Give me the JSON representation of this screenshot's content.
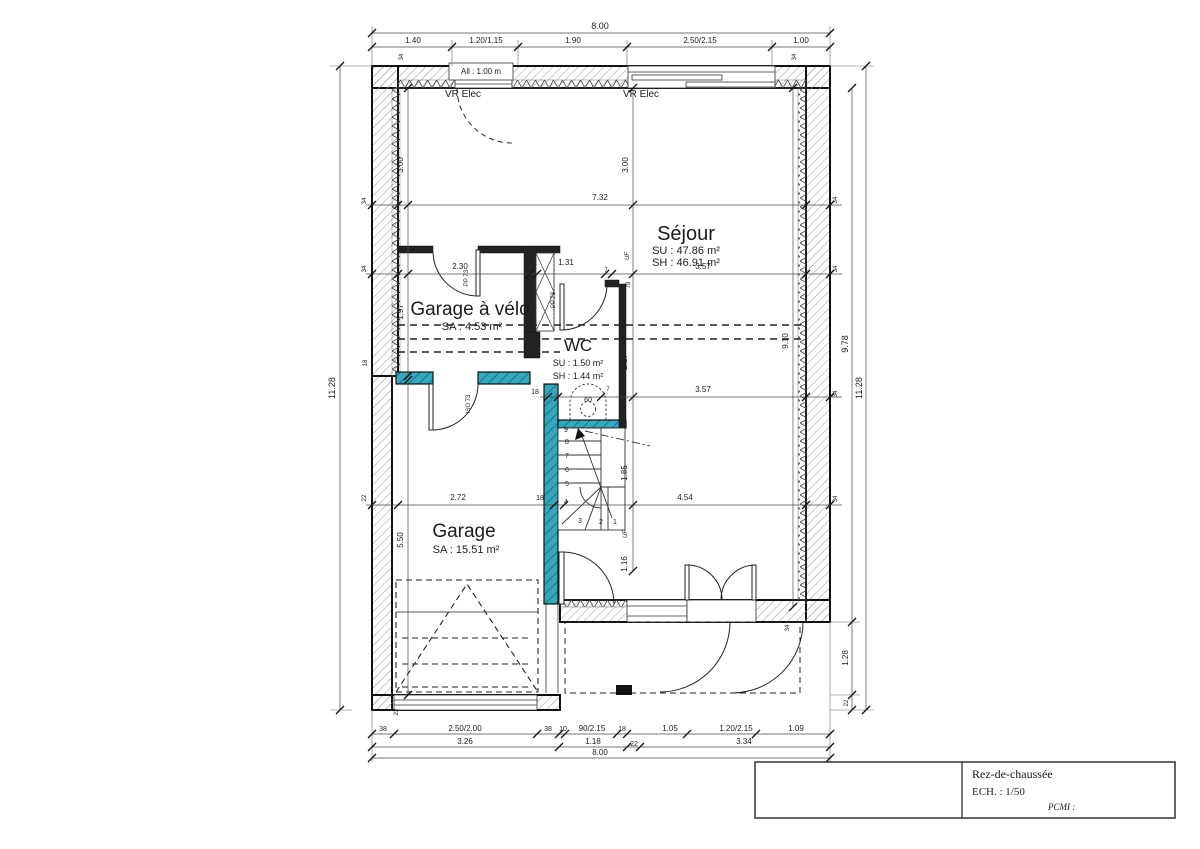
{
  "title_block": {
    "floor_label": "Rez-de-chaussée",
    "scale_label": "ECH. : 1/50",
    "pcmi_label": "PCMI :"
  },
  "rooms": {
    "sejour": {
      "name": "Séjour",
      "line1": "SU : 47.86 m²",
      "line2": "SH : 46.91 m²"
    },
    "garage_velo": {
      "name": "Garage à vélo",
      "line1": "SA : 4.53 m²"
    },
    "wc": {
      "name": "WC",
      "line1": "SU : 1.50 m²",
      "line2": "SH : 1.44 m²"
    },
    "garage": {
      "name": "Garage",
      "line1": "SA : 15.51 m²"
    }
  },
  "colors": {
    "wall_line": "#111111",
    "teal_wall": "#35a8bc",
    "hatch": "#8a8a8a"
  },
  "annotations": [
    {
      "t": "8.00",
      "x": 600,
      "y": 29,
      "s": 9
    },
    {
      "t": "1.40",
      "x": 413,
      "y": 43,
      "s": 8
    },
    {
      "t": "1.20/1.15",
      "x": 486,
      "y": 43,
      "s": 8
    },
    {
      "t": "1.90",
      "x": 573,
      "y": 43,
      "s": 8
    },
    {
      "t": "2.50/2.15",
      "x": 700,
      "y": 43,
      "s": 8
    },
    {
      "t": "1.00",
      "x": 801,
      "y": 43,
      "s": 8
    },
    {
      "t": "All : 1.00 m",
      "x": 481,
      "y": 74,
      "s": 8
    },
    {
      "t": "VR Elec",
      "x": 463,
      "y": 97,
      "s": 10
    },
    {
      "t": "VR Elec",
      "x": 641,
      "y": 97,
      "s": 10
    },
    {
      "t": "34",
      "x": 403,
      "y": 57,
      "r": -90,
      "s": 6
    },
    {
      "t": "34",
      "x": 796,
      "y": 57,
      "r": -90,
      "s": 6
    },
    {
      "t": "11.28",
      "x": 335,
      "y": 388,
      "r": -90,
      "s": 9
    },
    {
      "t": "34",
      "x": 366,
      "y": 201,
      "r": -90,
      "s": 6
    },
    {
      "t": "34",
      "x": 366,
      "y": 269,
      "r": -90,
      "s": 6
    },
    {
      "t": "18",
      "x": 367,
      "y": 363,
      "r": -90,
      "s": 6
    },
    {
      "t": "22",
      "x": 366,
      "y": 498,
      "r": -90,
      "s": 6
    },
    {
      "t": "3.00",
      "x": 403,
      "y": 165,
      "r": -90,
      "s": 8
    },
    {
      "t": "1.97",
      "x": 403,
      "y": 312,
      "r": -90,
      "s": 8
    },
    {
      "t": "5.50",
      "x": 403,
      "y": 540,
      "r": -90,
      "s": 8
    },
    {
      "t": "22",
      "x": 398,
      "y": 712,
      "r": -90,
      "s": 6
    },
    {
      "t": "9.78",
      "x": 848,
      "y": 344,
      "r": -90,
      "s": 9
    },
    {
      "t": "11.28",
      "x": 862,
      "y": 388,
      "r": -90,
      "s": 9
    },
    {
      "t": "1.28",
      "x": 848,
      "y": 658,
      "r": -90,
      "s": 8
    },
    {
      "t": "22",
      "x": 848,
      "y": 703,
      "r": -90,
      "s": 6
    },
    {
      "t": "34",
      "x": 837,
      "y": 200,
      "r": -90,
      "s": 6
    },
    {
      "t": "34",
      "x": 837,
      "y": 269,
      "r": -90,
      "s": 6
    },
    {
      "t": "34",
      "x": 837,
      "y": 394,
      "r": -90,
      "s": 6
    },
    {
      "t": "34",
      "x": 837,
      "y": 499,
      "r": -90,
      "s": 6
    },
    {
      "t": "34",
      "x": 789,
      "y": 628,
      "r": -90,
      "s": 6
    },
    {
      "t": "3.00",
      "x": 628,
      "y": 165,
      "r": -90,
      "s": 8
    },
    {
      "t": "7.32",
      "x": 600,
      "y": 200,
      "s": 8
    },
    {
      "t": "2.30",
      "x": 460,
      "y": 269,
      "s": 8
    },
    {
      "t": "1.31",
      "x": 566,
      "y": 265,
      "s": 8
    },
    {
      "t": "3.57",
      "x": 703,
      "y": 269,
      "s": 8
    },
    {
      "t": "3.57",
      "x": 703,
      "y": 392,
      "s": 8
    },
    {
      "t": "2.17",
      "x": 627,
      "y": 362,
      "r": -90,
      "s": 8
    },
    {
      "t": "9.10",
      "x": 788,
      "y": 341,
      "r": -90,
      "s": 8
    },
    {
      "t": "1.85",
      "x": 627,
      "y": 473,
      "r": -90,
      "s": 8
    },
    {
      "t": "1.16",
      "x": 627,
      "y": 564,
      "r": -90,
      "s": 8
    },
    {
      "t": "2.72",
      "x": 458,
      "y": 500,
      "s": 8
    },
    {
      "t": "18",
      "x": 540,
      "y": 500,
      "s": 7
    },
    {
      "t": "4.54",
      "x": 685,
      "y": 500,
      "s": 8
    },
    {
      "t": "18",
      "x": 535,
      "y": 394,
      "s": 7
    },
    {
      "t": "79",
      "x": 630,
      "y": 285,
      "r": -90,
      "s": 6
    },
    {
      "t": "7",
      "x": 403,
      "y": 253,
      "s": 6
    },
    {
      "t": "7",
      "x": 528,
      "y": 267,
      "s": 6
    },
    {
      "t": "7",
      "x": 606,
      "y": 272,
      "s": 6
    },
    {
      "t": "7",
      "x": 608,
      "y": 391,
      "s": 6
    },
    {
      "t": "PP 73",
      "x": 468,
      "y": 278,
      "r": -90,
      "s": 6
    },
    {
      "t": "PP 73",
      "x": 555,
      "y": 300,
      "r": -90,
      "s": 6
    },
    {
      "t": "ISO 73",
      "x": 470,
      "y": 404,
      "r": -90,
      "s": 6
    },
    {
      "t": "UF",
      "x": 629,
      "y": 256,
      "r": -90,
      "s": 6,
      "i": 1
    },
    {
      "t": "UF",
      "x": 627,
      "y": 534,
      "r": -90,
      "s": 6,
      "i": 1
    },
    {
      "t": "60",
      "x": 588,
      "y": 402,
      "s": 7
    },
    {
      "t": "9",
      "x": 566,
      "y": 432,
      "s": 7,
      "n": "stair-number"
    },
    {
      "t": "8",
      "x": 567,
      "y": 444,
      "s": 7,
      "n": "stair-number"
    },
    {
      "t": "7",
      "x": 567,
      "y": 458,
      "s": 7,
      "n": "stair-number"
    },
    {
      "t": "6",
      "x": 567,
      "y": 472,
      "s": 7,
      "n": "stair-number"
    },
    {
      "t": "5",
      "x": 567,
      "y": 486,
      "s": 7,
      "n": "stair-number"
    },
    {
      "t": "4",
      "x": 566,
      "y": 504,
      "s": 7,
      "n": "stair-number"
    },
    {
      "t": "3",
      "x": 580,
      "y": 523,
      "s": 7,
      "n": "stair-number"
    },
    {
      "t": "2",
      "x": 601,
      "y": 524,
      "s": 7,
      "n": "stair-number"
    },
    {
      "t": "1",
      "x": 615,
      "y": 524,
      "s": 7,
      "n": "stair-number"
    },
    {
      "t": "38",
      "x": 383,
      "y": 731,
      "s": 7
    },
    {
      "t": "2.50/2.00",
      "x": 465,
      "y": 731,
      "s": 8
    },
    {
      "t": "38",
      "x": 548,
      "y": 731,
      "s": 7
    },
    {
      "t": "10",
      "x": 563,
      "y": 731,
      "s": 7
    },
    {
      "t": "90/2.15",
      "x": 592,
      "y": 731,
      "s": 8
    },
    {
      "t": "18",
      "x": 622,
      "y": 731,
      "s": 7
    },
    {
      "t": "1.05",
      "x": 670,
      "y": 731,
      "s": 8
    },
    {
      "t": "1.20/2.15",
      "x": 736,
      "y": 731,
      "s": 8
    },
    {
      "t": "1.09",
      "x": 796,
      "y": 731,
      "s": 8
    },
    {
      "t": "3.26",
      "x": 465,
      "y": 744,
      "s": 8
    },
    {
      "t": "1.18",
      "x": 593,
      "y": 744,
      "s": 8
    },
    {
      "t": "22",
      "x": 634,
      "y": 746,
      "s": 7
    },
    {
      "t": "3.34",
      "x": 744,
      "y": 744,
      "s": 8
    },
    {
      "t": "8.00",
      "x": 600,
      "y": 755,
      "s": 8
    }
  ]
}
